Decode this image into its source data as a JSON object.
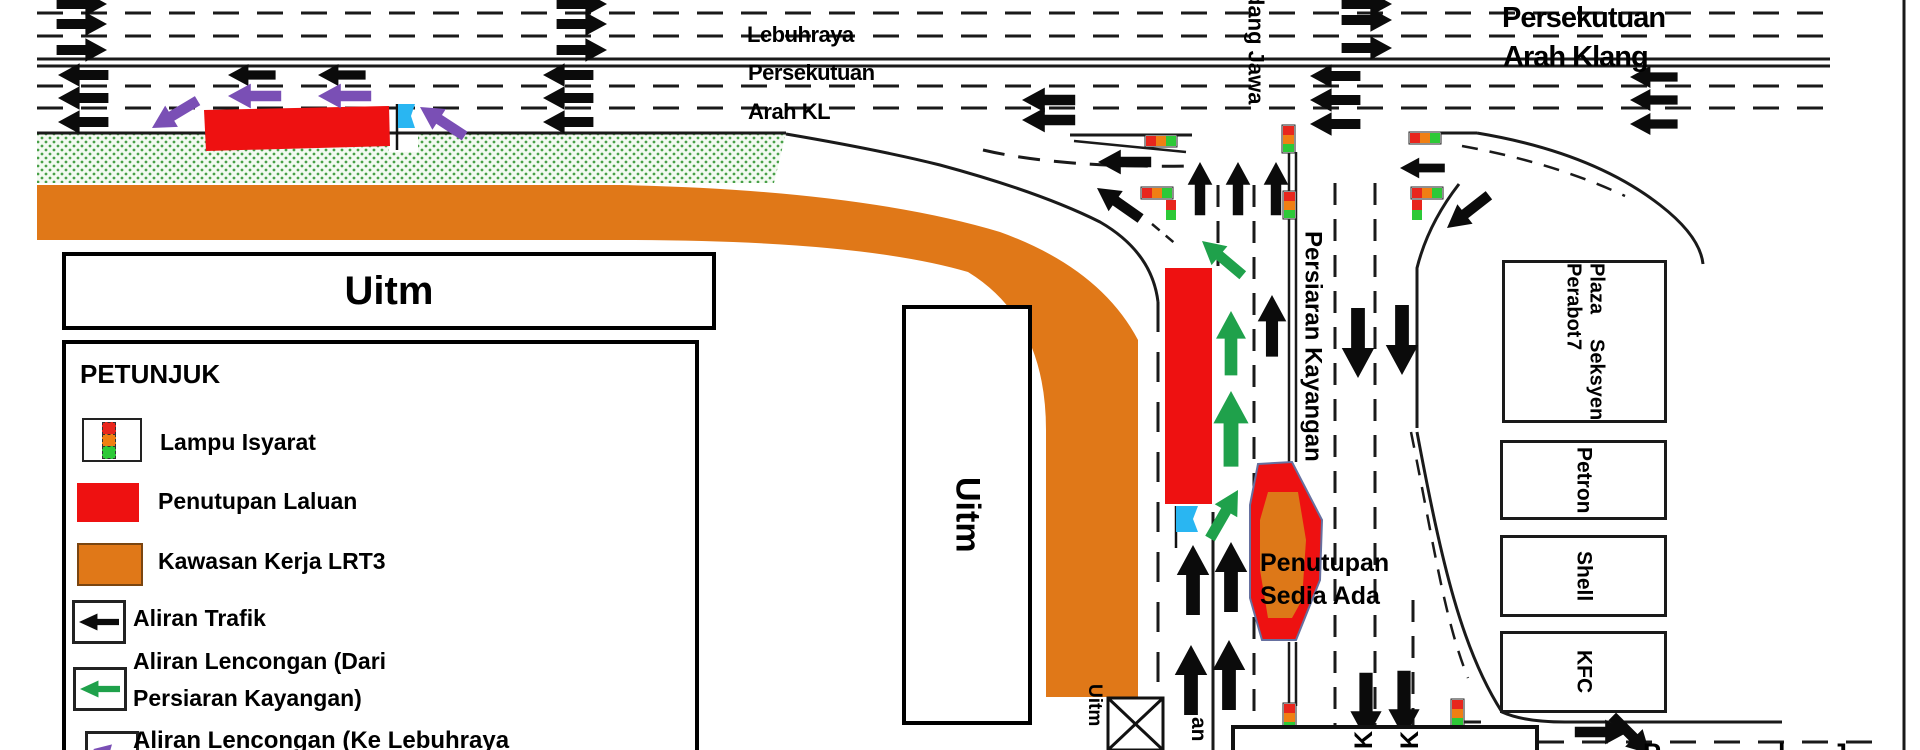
{
  "highway": {
    "kl1": "Lebuhraya",
    "kl2": "Persekutuan",
    "kl3": "Arah KL",
    "klang1": "Persekutuan",
    "klang2": "Arah Klang"
  },
  "roads": {
    "padang_jawa_partial": "dang Jawa",
    "persiaran_kayangan": "Persiaran Kayangan",
    "kayangan_tail": "an",
    "bottom_fragments": [
      "P",
      "l",
      "J"
    ]
  },
  "closure": {
    "line1": "Penutupan",
    "line2": "Sedia Ada"
  },
  "uitm": {
    "main": "Uitm",
    "vertical": "Uitm",
    "small": "Uitm"
  },
  "buildings": {
    "plaza1": "Plaza Perabot",
    "plaza2": "Seksyen 7",
    "petron": "Petron",
    "shell": "Shell",
    "kfc": "KFC"
  },
  "signs": {
    "k1": "K",
    "k2": "K"
  },
  "legend": {
    "title": "PETUNJUK",
    "items": [
      "Lampu Isyarat",
      "Penutupan Laluan",
      "Kawasan Kerja LRT3",
      "Aliran Trafik",
      "Aliran Lencongan (Dari",
      "Persiaran Kayangan)",
      "Aliran Lencongan (Ke Lebuhraya"
    ]
  },
  "colors": {
    "closure_red": "#ee1111",
    "work_area_orange": "#e07818",
    "diversion_green": "#1fa14b",
    "diversion_purple": "#7a4fb5",
    "flag_cyan": "#29b6f2",
    "light_red": "#e8261d",
    "light_amber": "#f07f13",
    "light_green": "#2dc937"
  }
}
